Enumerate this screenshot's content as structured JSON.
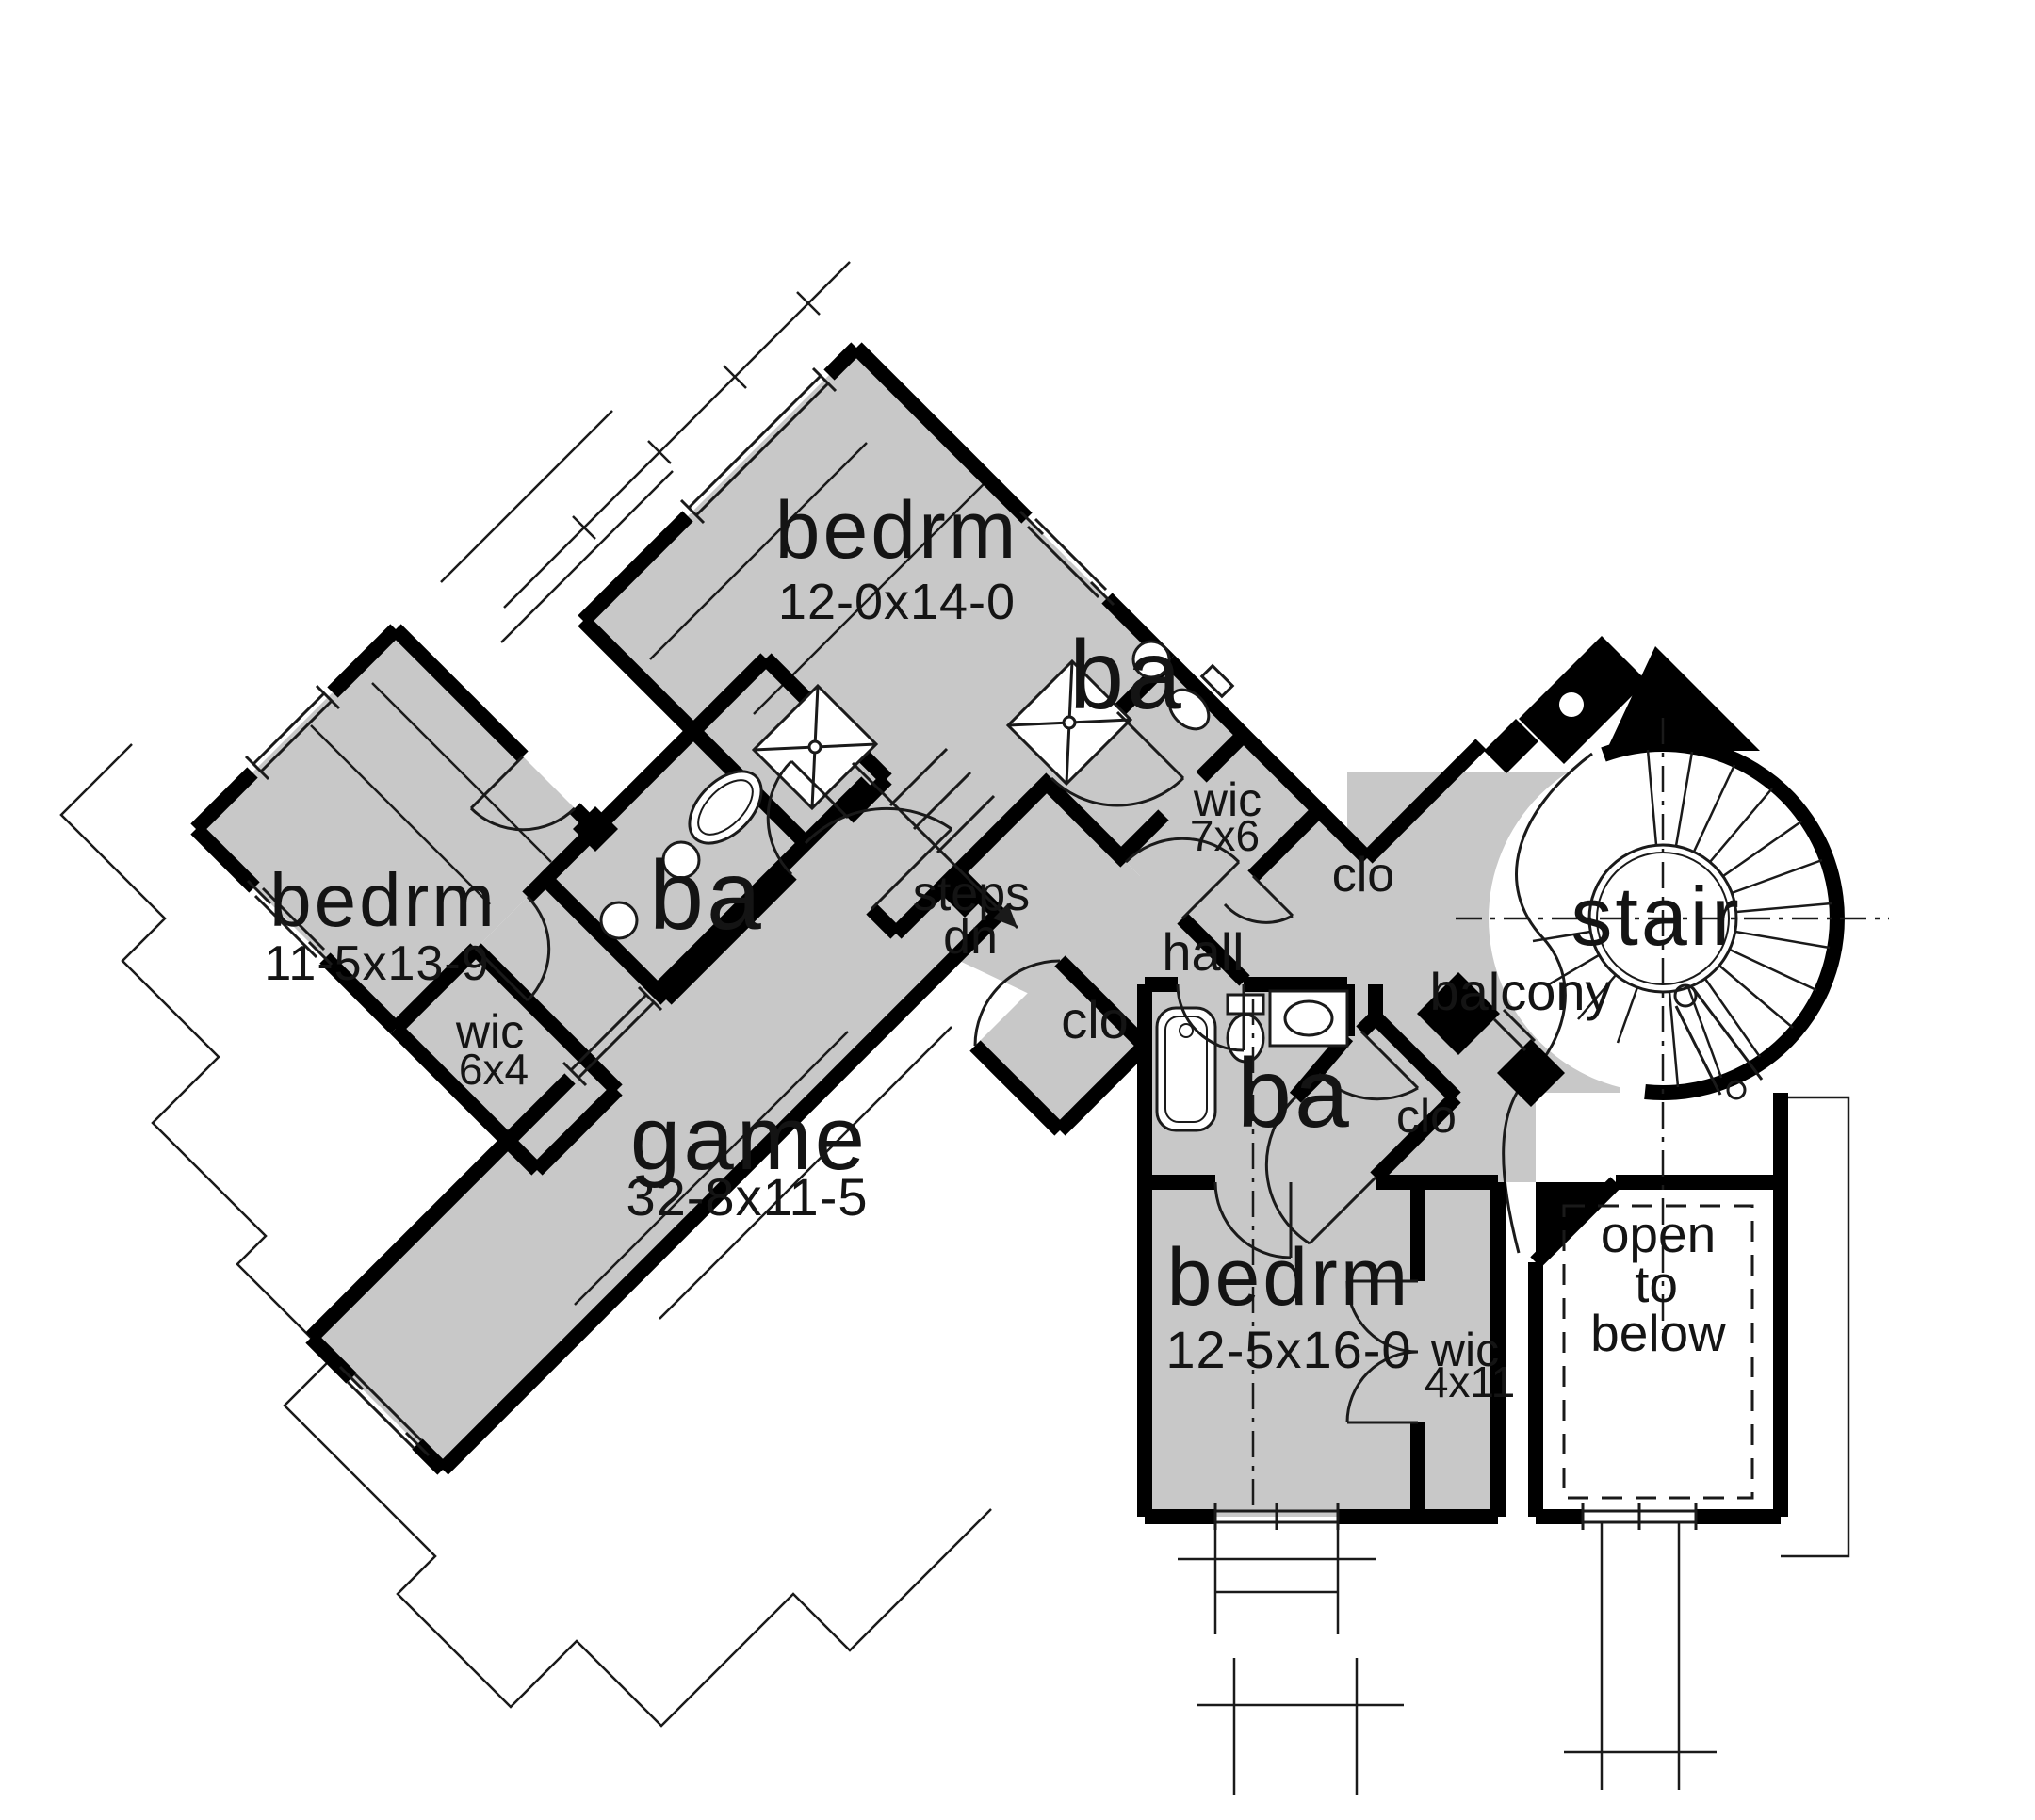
{
  "drawing": {
    "kind": "second-floor plan",
    "colors": {
      "floor_fill": "#c8c8c8",
      "wall": "#000000",
      "background": "#ffffff",
      "line": "#1a1a1a"
    }
  },
  "rooms": {
    "bedroom_top": {
      "label": "bedrm",
      "dims": "12-0x14-0"
    },
    "bath_top": {
      "label": "ba"
    },
    "wic_top": {
      "label": "wic",
      "dims": "7x6"
    },
    "closet_top": {
      "label": "clo"
    },
    "steps": {
      "line1": "steps",
      "line2": "dn"
    },
    "hall": {
      "label": "hall"
    },
    "closet_center": {
      "label": "clo"
    },
    "bath_middle": {
      "label": "ba"
    },
    "bedroom_left": {
      "label": "bedrm",
      "dims": "11-5x13-9"
    },
    "wic_left": {
      "label": "wic",
      "dims": "6x4"
    },
    "game": {
      "label": "game",
      "dims": "32-8x11-5"
    },
    "balcony": {
      "label": "balcony"
    },
    "stair": {
      "label": "stair"
    },
    "bath_bottom": {
      "label": "ba"
    },
    "closet_bottom": {
      "label": "clo"
    },
    "bedroom_bottom": {
      "label": "bedrm",
      "dims": "12-5x16-0"
    },
    "wic_bottom": {
      "label": "wic",
      "dims": "4x11"
    },
    "open_to_below": {
      "line1": "open",
      "line2": "to",
      "line3": "below"
    }
  }
}
